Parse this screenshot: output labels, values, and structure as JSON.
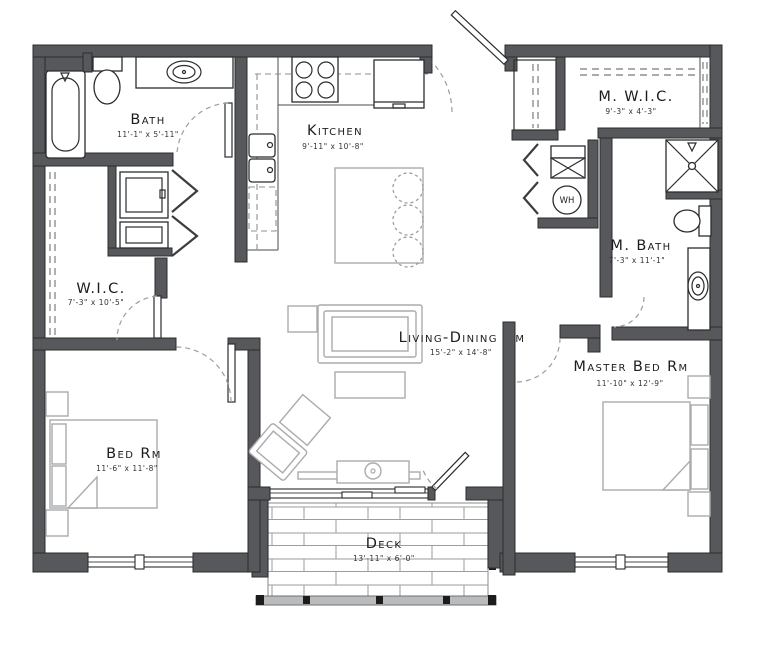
{
  "plan": {
    "type": "apartment-floor-plan",
    "colors": {
      "wall": "#57585b",
      "furniture": "#a9abae",
      "text": "#1c1c1c"
    },
    "rooms": [
      {
        "id": "bath",
        "name": "Bath",
        "dims": "11'-1\" x 5'-11\""
      },
      {
        "id": "kitchen",
        "name": "Kitchen",
        "dims": "9'-11\" x 10'-8\""
      },
      {
        "id": "mwic",
        "name": "M. W.I.C.",
        "dims": "9'-3\" x 4'-3\""
      },
      {
        "id": "mbath",
        "name": "M. Bath",
        "dims": "7'-3\" x 11'-1\""
      },
      {
        "id": "wic",
        "name": "W.I.C.",
        "dims": "7'-3\" x 10'-5\""
      },
      {
        "id": "living",
        "name": "Living-Dining Rm",
        "dims": "15'-2\" x 14'-8\""
      },
      {
        "id": "master",
        "name": "Master Bed Rm",
        "dims": "11'-10\" x 12'-9\""
      },
      {
        "id": "bedrm",
        "name": "Bed Rm",
        "dims": "11'-6\" x 11'-8\""
      },
      {
        "id": "deck",
        "name": "Deck",
        "dims": "13'-11\" x 6'-0\""
      }
    ],
    "fixtures": {
      "water_heater": "WH"
    }
  }
}
